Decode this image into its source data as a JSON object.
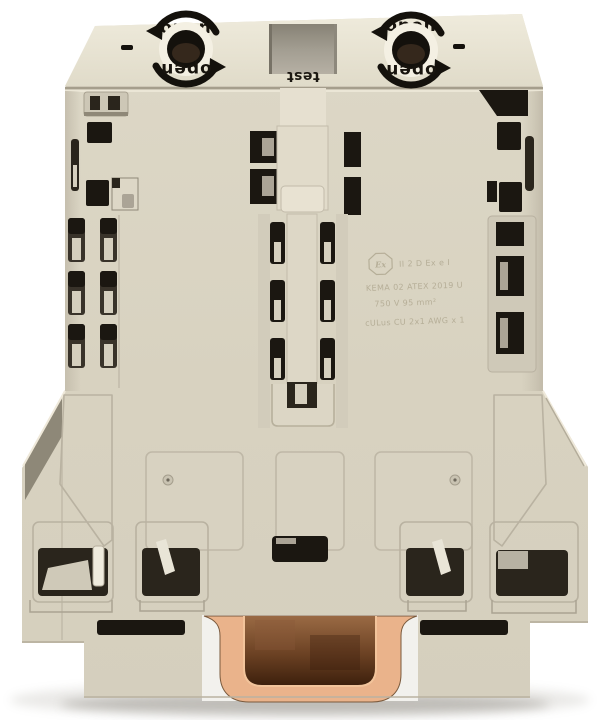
{
  "photo": {
    "alt": "Beige rail-mount high-current terminal block, front view, with copper DIN-rail channel at the bottom"
  },
  "labels": {
    "screw_left_top": "open",
    "screw_left_bottom": "open",
    "screw_right_top": "open",
    "screw_right_bottom": "open",
    "test_port": "test"
  },
  "marking": {
    "ex_symbol": "Ex",
    "line1": "II 2 D Ex e I",
    "line2": "KEMA 02 ATEX 2019 U",
    "line3": "750 V  95 mm²",
    "line4": "cULus  CU 2x1 AWG x 1"
  },
  "colors": {
    "background": "#ffffff",
    "body": "#d9d3c2",
    "body_light": "#ebe6d7",
    "body_shadow": "#b9b2a0",
    "detail_dark": "#1b1711",
    "recess_gray": "#a29d91",
    "copper": "#eab38b",
    "copper_dark": "#5d371d",
    "marking_text": "#b2aa93"
  }
}
